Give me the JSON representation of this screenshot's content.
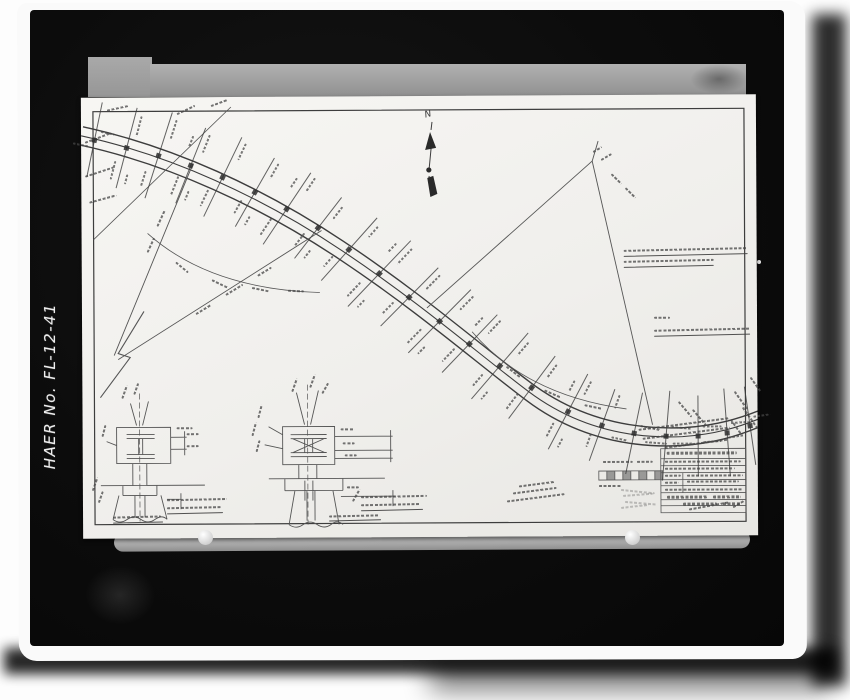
{
  "archive_label": "HAER No. FL-12-41",
  "north_label": "N",
  "colors": {
    "page_background": "#fdfdfd",
    "photo_paper": "#fafafa",
    "mat_black": "#0c0c0c",
    "backing_gray": "#a0a0a0",
    "sheet_paper": "#f2f1ee",
    "ink": "#3d3d3d",
    "label_white": "#ededed"
  },
  "drawing": {
    "paths": {
      "border": "M 12 14 H 663 V 427 H 12 Z",
      "road_upper": "M 2 29 C 92 49 182 91 262 145 C 342 199 398 249 448 287 C 498 325 552 335 602 333 C 634 331 658 324 680 315",
      "road_center": "M 0 38 C 90 58 180 100 260 154 C 340 208 396 258 446 296 C 496 334 550 344 600 342 C 632 340 656 333 678 324",
      "road_lower": "M -2 47 C 88 67 178 109 258 163 C 338 217 394 267 444 305 C 494 343 548 353 598 351 C 630 349 654 342 676 333",
      "fan_left_1": "M 112 66 L 32 258",
      "fan_left_2": "M 240 134 L 36 262",
      "fan_left_zigzag": "M 62 214 L 36 256 L 48 260 L 18 300",
      "fan_left_arc": "M 66 136 Q 128 192 238 196",
      "fan_right_left": "M 511 66 L 345 212",
      "fan_right_right": "M 511 66 L 570 330",
      "fan_right_tip": "M 511 66 L 517 46",
      "fan_right_arc": "M 390 236 Q 444 300 544 314",
      "back_tangent": "M 12 142 L 150 10",
      "north_stroke": "M 351 26 L 350 34 M 350 52 L 348 72 M 348 80 L 347 84",
      "north_fill": "M 349 36 L 355 52 L 344 54 Z M 346 82 L 352 80 L 356 98 L 349 101 Z M 345 74 a 2.6 2.6 0 1 0 5.2 0 a 2.6 2.6 0 1 0 -5.2 0",
      "detail1": "M 34 330 H 88 V 366 H 34 Z M 44 337 H 72 M 44 341 H 72 M 44 357 H 72 M 44 361 H 72 M 56 341 V 357 M 60 341 V 357 M 88 340 H 104 M 88 352 H 104 M 102 334 V 358 M 48 306 L 54 328 M 66 304 L 60 328 M 24 344 L 34 348 M 50 366 V 388 M 64 366 V 388 M 18 388 H 122 M 40 388 V 398 M 74 388 V 398 M 40 398 H 74 M 36 398 L 30 422 M 78 398 L 84 422 M 52 398 V 420 M 62 398 V 420 M 30 422 q 7 5 14 0 q 7 -5 14 0 q 7 5 14 0 q 7 -5 12 0 M 84 402 H 98 M 98 396 V 412",
      "detail1_center": "M 57 296 V 424",
      "detail2": "M 200 330 H 252 V 368 H 200 Z M 208 338 H 244 M 208 342 H 244 M 208 356 H 244 M 208 360 H 244 M 210 342 L 242 356 M 242 342 L 210 356 M 222 342 V 356 M 230 342 V 356 M 252 340 H 310 M 252 354 H 310 M 252 362 H 310 M 308 334 V 366 M 214 296 L 222 328 M 236 294 L 228 328 M 186 330 L 200 338 M 182 348 L 200 352 M 216 368 V 382 M 234 368 V 382 M 186 382 H 302 M 202 382 V 394 M 260 382 V 394 M 202 394 H 260 M 222 384 V 404 M 230 384 V 404 M 212 394 L 206 428 M 250 394 L 256 428 M 224 394 V 424 M 232 394 V 424 M 206 428 q 7 5 14 0 q 7 -5 14 0 q 7 5 14 0 q 6 -5 12 0 M 258 400 H 312 M 310 394 V 410",
      "detail2_center": "M 225 288 V 428",
      "title_block": "M 578 354 H 663 V 418 H 578 Z M 578 364 H 663 M 578 371 H 663 M 578 378 H 663 M 600 378 V 398 M 578 385 H 663 M 578 391 H 663 M 578 398 H 663 M 578 405 H 663 M 578 411 H 663",
      "scale_bar": "M 516 376 H 580 V 385 H 516 Z M 524 376 V 385 M 532 376 V 385 M 540 376 V 385 M 548 376 V 385 M 556 376 V 385 M 564 376 V 385 M 572 376 V 385",
      "scale_bar_fill": "M 524 376 h 8 v 9 h -8 Z M 540 376 h 8 v 9 h -8 Z M 556 376 h 8 v 9 h -8 Z M 572 376 h 8 v 9 h -8 Z"
    },
    "bents": [
      [
        14,
        42,
        12
      ],
      [
        46,
        50,
        15
      ],
      [
        78,
        58,
        18
      ],
      [
        110,
        68,
        22
      ],
      [
        142,
        80,
        26
      ],
      [
        174,
        95,
        30
      ],
      [
        206,
        112,
        34
      ],
      [
        237,
        131,
        38
      ],
      [
        268,
        153,
        42
      ],
      [
        298,
        177,
        44
      ],
      [
        328,
        201,
        45
      ],
      [
        358,
        225,
        45
      ],
      [
        388,
        248,
        44
      ],
      [
        418,
        270,
        41
      ],
      [
        450,
        292,
        37
      ],
      [
        486,
        316,
        28
      ],
      [
        520,
        330,
        20
      ],
      [
        552,
        338,
        12
      ],
      [
        584,
        341,
        5
      ],
      [
        616,
        341,
        0
      ],
      [
        645,
        338,
        -4
      ],
      [
        668,
        331,
        -8
      ]
    ],
    "scribbles": [
      [
        4,
        44,
        26,
        -20
      ],
      [
        4,
        78,
        30,
        -18
      ],
      [
        8,
        104,
        28,
        -15
      ],
      [
        26,
        12,
        22,
        -12
      ],
      [
        96,
        16,
        20,
        -25
      ],
      [
        130,
        8,
        18,
        -20
      ],
      [
        76,
        128,
        18,
        -65
      ],
      [
        66,
        154,
        16,
        -65
      ],
      [
        114,
        216,
        18,
        -31
      ],
      [
        144,
        197,
        20,
        -31
      ],
      [
        176,
        178,
        16,
        -31
      ],
      [
        94,
        164,
        16,
        40
      ],
      [
        130,
        182,
        18,
        26
      ],
      [
        170,
        190,
        18,
        12
      ],
      [
        206,
        193,
        16,
        3
      ],
      [
        424,
        270,
        18,
        38
      ],
      [
        462,
        294,
        18,
        24
      ],
      [
        502,
        309,
        18,
        12
      ],
      [
        512,
        56,
        10,
        -30
      ],
      [
        520,
        64,
        12,
        -30
      ],
      [
        530,
        78,
        14,
        45
      ],
      [
        544,
        92,
        14,
        45
      ],
      [
        652,
        296,
        22,
        55
      ],
      [
        660,
        312,
        26,
        55
      ],
      [
        648,
        324,
        18,
        55
      ],
      [
        668,
        282,
        18,
        55
      ],
      [
        556,
        334,
        92,
        -7
      ],
      [
        560,
        343,
        88,
        -7
      ],
      [
        582,
        352,
        64,
        -7
      ],
      [
        596,
        306,
        20,
        50
      ],
      [
        610,
        314,
        22,
        50
      ],
      [
        542,
        155,
        124,
        -1
      ],
      [
        542,
        161,
        124,
        -1,
        1,
        0.9,
        1
      ],
      [
        542,
        166,
        90,
        -1
      ],
      [
        542,
        172,
        90,
        -1,
        1,
        0.9,
        1
      ],
      [
        572,
        222,
        16,
        0
      ],
      [
        572,
        235,
        96,
        -1
      ],
      [
        572,
        241,
        96,
        -1,
        1,
        0.9,
        1
      ],
      [
        436,
        390,
        36,
        -7
      ],
      [
        430,
        397,
        44,
        -7
      ],
      [
        424,
        405,
        58,
        -7
      ],
      [
        520,
        366,
        30,
        0
      ],
      [
        554,
        366,
        16,
        0
      ],
      [
        516,
        390,
        22,
        0
      ],
      [
        584,
        357,
        70,
        0,
        2.8
      ],
      [
        582,
        366,
        76,
        0
      ],
      [
        582,
        373,
        70,
        0
      ],
      [
        604,
        380,
        56,
        0
      ],
      [
        604,
        386,
        52,
        0
      ],
      [
        582,
        380,
        16,
        0
      ],
      [
        582,
        387,
        14,
        0
      ],
      [
        582,
        394,
        78,
        0
      ],
      [
        584,
        401,
        40,
        0,
        2.6
      ],
      [
        630,
        401,
        28,
        0,
        2.6
      ],
      [
        600,
        408,
        34,
        0,
        3
      ],
      [
        640,
        408,
        18,
        0,
        3
      ],
      [
        606,
        414,
        40,
        -10,
        2.2
      ],
      [
        650,
        412,
        14,
        -30,
        2.2
      ],
      [
        538,
        394,
        34,
        6,
        1.5,
        0.3
      ],
      [
        540,
        400,
        30,
        -4,
        1.5,
        0.3
      ],
      [
        542,
        406,
        32,
        5,
        1.5,
        0.3
      ],
      [
        538,
        412,
        28,
        -6,
        1.5,
        0.3
      ],
      [
        40,
        300,
        14,
        -70
      ],
      [
        52,
        296,
        12,
        -70
      ],
      [
        20,
        338,
        12,
        -75
      ],
      [
        94,
        330,
        16,
        0
      ],
      [
        104,
        336,
        12,
        0
      ],
      [
        104,
        348,
        12,
        0
      ],
      [
        84,
        402,
        60,
        -1
      ],
      [
        84,
        410,
        54,
        -1
      ],
      [
        84,
        416,
        56,
        -1,
        1,
        0.9,
        1
      ],
      [
        30,
        419,
        48,
        -1
      ],
      [
        30,
        425,
        50,
        -1,
        1,
        0.9,
        1
      ],
      [
        10,
        392,
        14,
        -70
      ],
      [
        16,
        404,
        12,
        -70
      ],
      [
        210,
        294,
        14,
        -70
      ],
      [
        228,
        290,
        14,
        -70
      ],
      [
        240,
        296,
        12,
        -60
      ],
      [
        176,
        320,
        14,
        -75
      ],
      [
        170,
        338,
        14,
        -75
      ],
      [
        174,
        354,
        12,
        -75
      ],
      [
        258,
        332,
        14,
        0
      ],
      [
        260,
        346,
        12,
        0
      ],
      [
        262,
        358,
        12,
        0
      ],
      [
        264,
        390,
        12,
        0
      ],
      [
        270,
        404,
        14,
        -60
      ],
      [
        278,
        400,
        66,
        -1
      ],
      [
        278,
        408,
        60,
        -1
      ],
      [
        278,
        414,
        62,
        -1,
        1,
        0.9,
        1
      ],
      [
        246,
        419,
        50,
        -1
      ],
      [
        246,
        424,
        52,
        -1,
        1,
        0.9,
        1
      ]
    ]
  }
}
